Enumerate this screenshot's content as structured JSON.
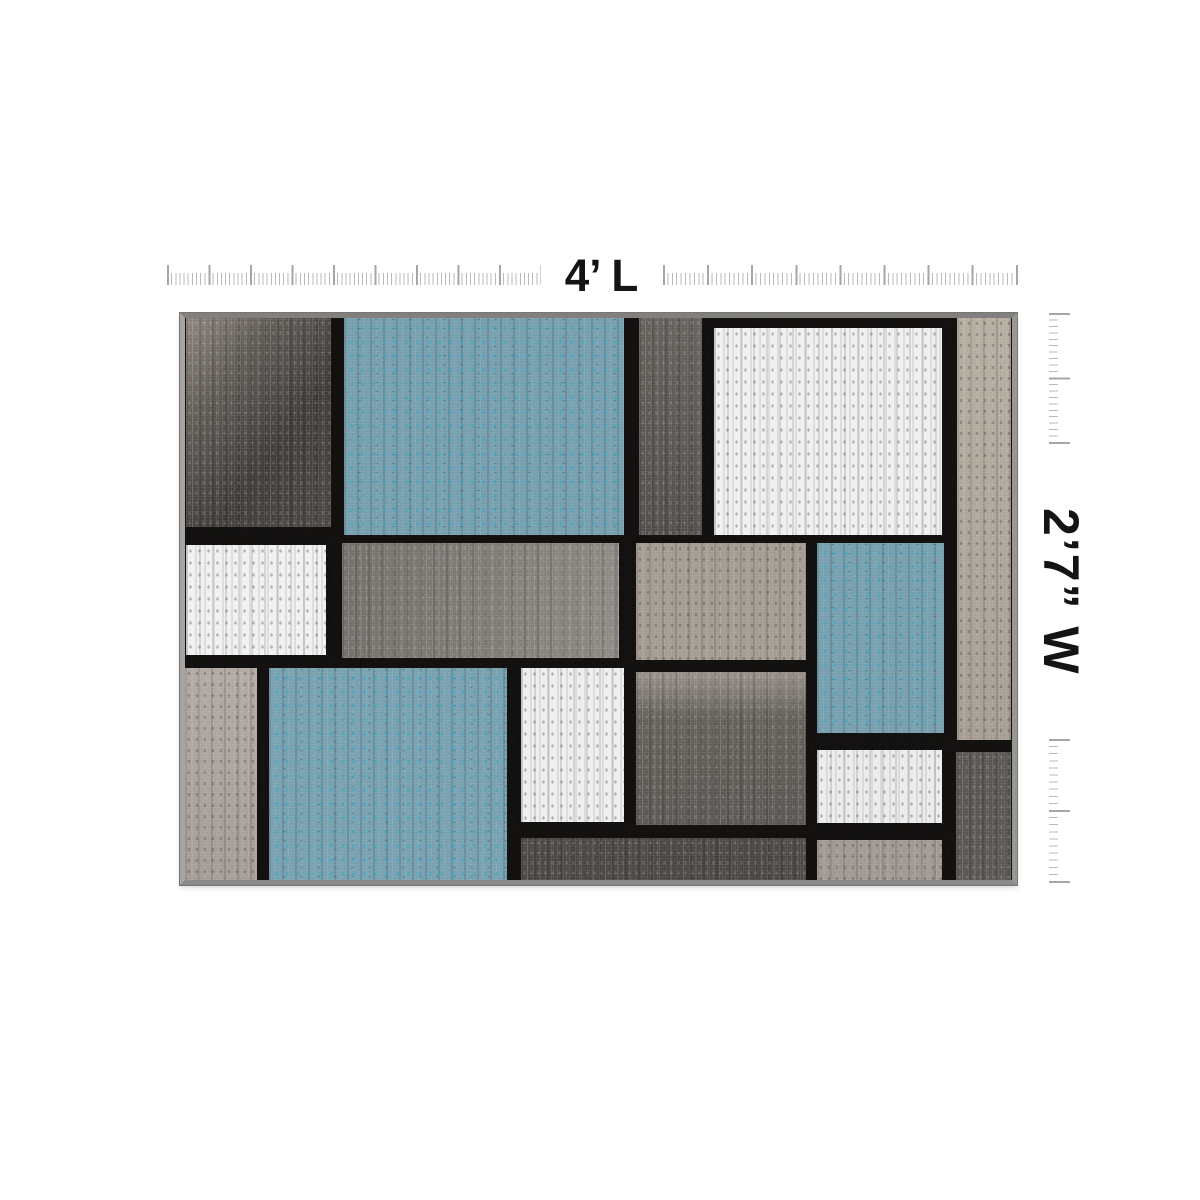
{
  "dimensions": {
    "length_label": "4’ L",
    "width_label": "2’7” W"
  },
  "colors": {
    "page_bg": "#ffffff",
    "tick": "#b9b9b9",
    "tick_major": "#a6a6a6",
    "label": "#141414",
    "rug_line": "#0e0d0c",
    "rug_edge": "#9a9a98",
    "blue": "#6d98a8",
    "white": "#eef0ee",
    "charcoal": "#3a3633",
    "gray": "#787370",
    "taupe": "#a29a8e"
  },
  "rug": {
    "blocks": [
      {
        "name": "charcoal-top-left",
        "x": 1,
        "y": 0,
        "w": 145,
        "h": 209,
        "grad": "128deg, #837c75, #56504b 28%, #35312e 62%, #403c38",
        "tex": "dark"
      },
      {
        "name": "blue-top",
        "x": 159,
        "y": 0,
        "w": 280,
        "h": 217,
        "color": "#6d98a8",
        "tex": "blue"
      },
      {
        "name": "gray-top-mid",
        "x": 454,
        "y": 0,
        "w": 63,
        "h": 217,
        "grad": "180deg, #5a5550, #474340",
        "tex": "dark"
      },
      {
        "name": "white-top",
        "x": 529,
        "y": 10,
        "w": 228,
        "h": 207,
        "color": "#edefed",
        "tex": "white"
      },
      {
        "name": "taupe-right-strip",
        "x": 772,
        "y": 0,
        "w": 54,
        "h": 422,
        "grad": "180deg, #b0a79a, #9f968a",
        "tex": "tan"
      },
      {
        "name": "white-mid-left",
        "x": 1,
        "y": 227,
        "w": 140,
        "h": 110,
        "color": "#eef0ee",
        "tex": "white"
      },
      {
        "name": "gray-mid",
        "x": 157,
        "y": 225,
        "w": 277,
        "h": 115,
        "grad": "90deg, #69645f, #847e78",
        "tex": "dark"
      },
      {
        "name": "taupe-mid",
        "x": 451,
        "y": 225,
        "w": 170,
        "h": 117,
        "color": "#9c948a",
        "tex": "tan"
      },
      {
        "name": "blue-mid-right",
        "x": 632,
        "y": 225,
        "w": 127,
        "h": 190,
        "color": "#6d98a8",
        "tex": "blue"
      },
      {
        "name": "taupe-bottom-left",
        "x": 0,
        "y": 350,
        "w": 72,
        "h": 212,
        "grad": "180deg, #aaa39b, #9c958d",
        "tex": "tan"
      },
      {
        "name": "blue-bottom",
        "x": 84,
        "y": 350,
        "w": 238,
        "h": 212,
        "color": "#6f9aaa",
        "tex": "blue"
      },
      {
        "name": "white-bottom-mid",
        "x": 336,
        "y": 350,
        "w": 103,
        "h": 154,
        "color": "#eceeec",
        "tex": "white"
      },
      {
        "name": "gray-bottom-mid",
        "x": 451,
        "y": 354,
        "w": 170,
        "h": 153,
        "grad": "180deg, #8d867e, #5a554f 30%, #514c48",
        "tex": "dark"
      },
      {
        "name": "charcoal-bottom-strip",
        "x": 336,
        "y": 520,
        "w": 285,
        "h": 42,
        "color": "#3f3c39",
        "tex": "dark"
      },
      {
        "name": "white-bottom-right",
        "x": 632,
        "y": 432,
        "w": 125,
        "h": 73,
        "color": "#e9ebe9",
        "tex": "white"
      },
      {
        "name": "taupe-bottom-strip",
        "x": 632,
        "y": 522,
        "w": 125,
        "h": 40,
        "color": "#99908a",
        "tex": "tan"
      },
      {
        "name": "gray-bottom-right",
        "x": 771,
        "y": 434,
        "w": 55,
        "h": 128,
        "color": "#4e4a47",
        "tex": "dark"
      }
    ]
  }
}
